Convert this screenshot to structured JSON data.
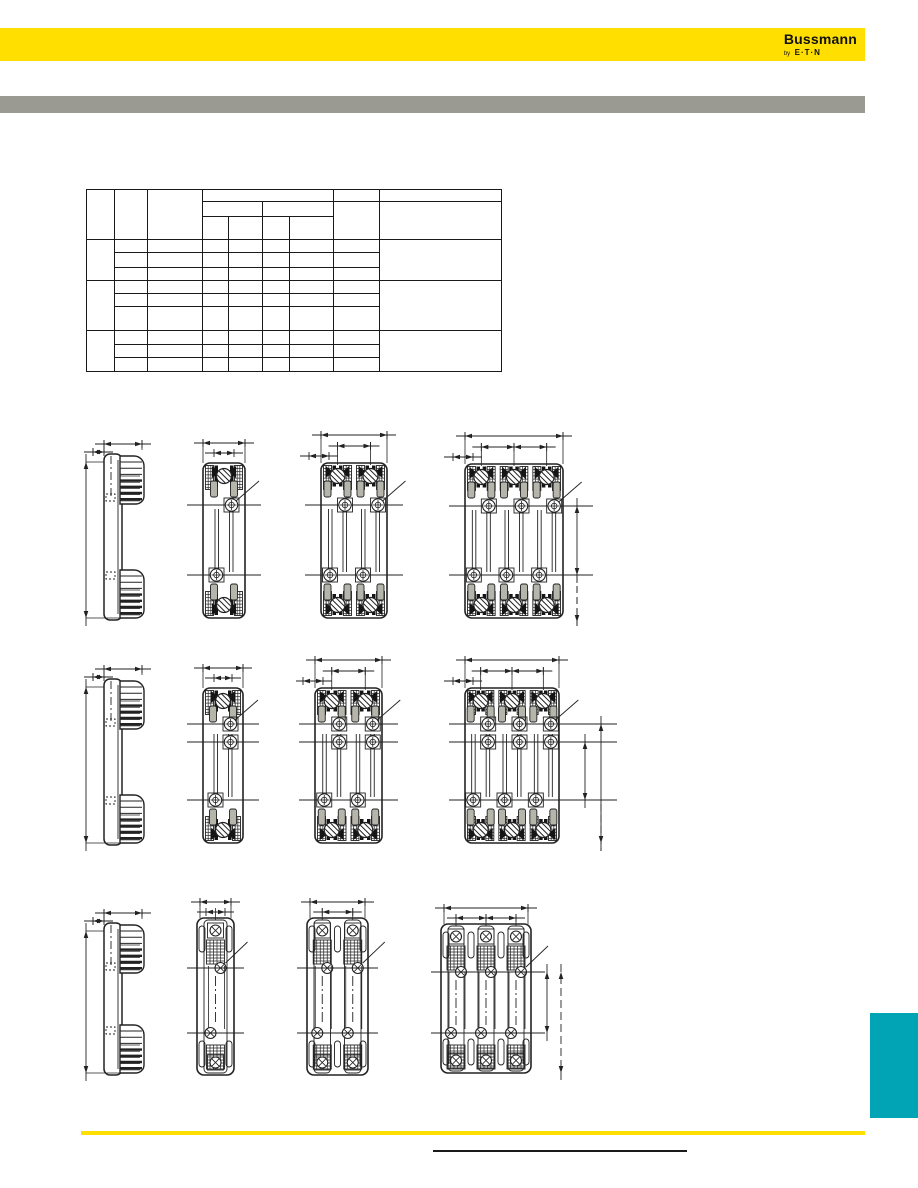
{
  "header": {
    "brand": "Bussmann",
    "byline_prefix": "by",
    "byline_brand": "E·T·N"
  },
  "colors": {
    "brand_yellow": "#FFDF00",
    "divider_gray": "#9A9A92",
    "edge_tab_teal": "#00A4B4",
    "drawing_line": "#222222",
    "rule_black": "#1a1a1a"
  },
  "table": {
    "columns": 9,
    "header_rows": 3,
    "body_row_groups": 3,
    "rows_per_group": 3,
    "all_cells_empty": true
  },
  "figures": {
    "rows": [
      {
        "row": 1,
        "drawings": [
          "side-profile-view",
          "1-pole-front-view",
          "2-pole-front-view",
          "3-pole-front-view"
        ]
      },
      {
        "row": 2,
        "drawings": [
          "side-profile-view",
          "1-pole-front-view",
          "2-pole-front-view",
          "3-pole-front-view"
        ]
      },
      {
        "row": 3,
        "drawings": [
          "side-profile-view",
          "1-pole-front-view",
          "2-pole-front-view",
          "3-pole-front-view"
        ]
      }
    ]
  }
}
